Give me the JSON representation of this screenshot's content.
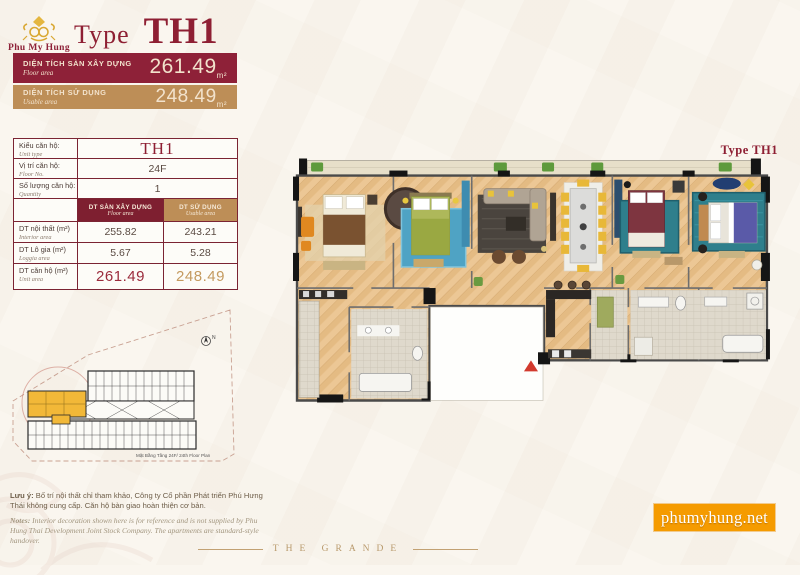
{
  "brand": {
    "name": "Phu My Hung"
  },
  "title": {
    "word": "Type",
    "value": "TH1"
  },
  "banners": [
    {
      "vn": "DIỆN TÍCH SÀN XÂY DỰNG",
      "en": "Floor area",
      "value": "261.49",
      "unit": "m²"
    },
    {
      "vn": "DIỆN TÍCH SỬ DỤNG",
      "en": "Usable area",
      "value": "248.49",
      "unit": "m²"
    }
  ],
  "spec_table": {
    "info_rows": [
      {
        "vn": "Kiểu căn hộ:",
        "en": "Unit type",
        "value": "TH1"
      },
      {
        "vn": "Vị trí căn hộ:",
        "en": "Floor No.",
        "value": "24F"
      },
      {
        "vn": "Số lượng căn hộ:",
        "en": "Quantity",
        "value": "1"
      }
    ],
    "col_headers": [
      {
        "vn": "DT SÀN XÂY DỰNG",
        "en": "Floor area"
      },
      {
        "vn": "DT SỬ DỤNG",
        "en": "Usable area"
      }
    ],
    "area_rows": [
      {
        "vn": "DT nội thất (m²)",
        "en": "Interior area",
        "floor": "255.82",
        "usable": "243.21"
      },
      {
        "vn": "DT Lô gia (m²)",
        "en": "Loggia area",
        "floor": "5.67",
        "usable": "5.28"
      },
      {
        "vn": "DT căn hộ (m²)",
        "en": "Unit area",
        "floor": "261.49",
        "usable": "248.49"
      }
    ]
  },
  "floor_plan": {
    "corner_label": "Type TH1"
  },
  "site_plan": {
    "caption": "Mặt Bằng Tầng 24F/ 24th Floor Plan",
    "compass": "N"
  },
  "notes": {
    "vn_lead": "Lưu ý:",
    "vn_text": " Bố trí nội thất chỉ tham khảo, Công ty Cổ phần Phát triển Phú Hưng Thái không cung cấp. Căn hộ bàn giao hoàn thiện cơ bản.",
    "en_lead": "Notes:",
    "en_text": " Interior decoration shown here is for reference and is not supplied by Phu Hung Thai Development Joint Stock Company. The apartments are standard-style handover."
  },
  "footer": {
    "website": "phumyhung.net",
    "project": "THE GRANDE"
  },
  "colors": {
    "dark_red": "#8E2138",
    "gold": "#BD8E57",
    "accent_orange": "#F59B00",
    "highlight_yellow": "#F2B838"
  }
}
